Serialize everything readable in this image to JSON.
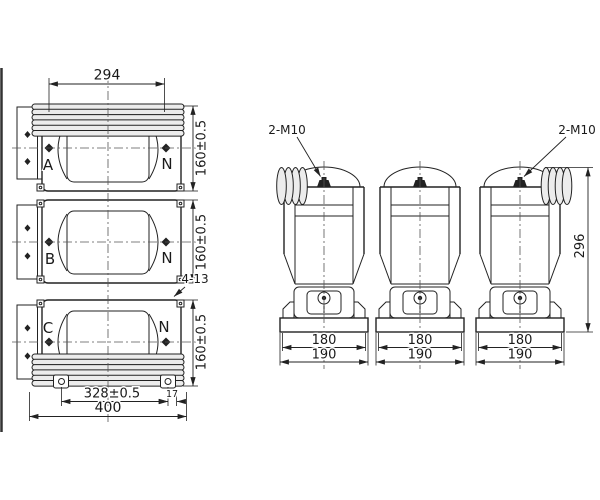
{
  "front_view": {
    "width_dim_top": "294",
    "units": [
      {
        "phase": "A",
        "neutral": "N",
        "height_dim": "160±0.5"
      },
      {
        "phase": "B",
        "neutral": "N",
        "height_dim": "160±0.5"
      },
      {
        "phase": "C",
        "neutral": "N",
        "height_dim": "160±0.5"
      }
    ],
    "mounting_holes_note": "4-13",
    "hole_edge_dim": "17",
    "hole_span_dim": "328±0.5",
    "overall_width_dim": "400"
  },
  "side_view": {
    "terminal_note_left": "2-M10",
    "terminal_note_right": "2-M10",
    "overall_height_dim": "296",
    "views": [
      {
        "base_inner_dim": "180",
        "base_outer_dim": "190"
      },
      {
        "base_inner_dim": "180",
        "base_outer_dim": "190"
      },
      {
        "base_inner_dim": "180",
        "base_outer_dim": "190"
      }
    ]
  },
  "colors": {
    "line": "#222222",
    "fin_fill": "#ececec",
    "background": "#ffffff"
  }
}
